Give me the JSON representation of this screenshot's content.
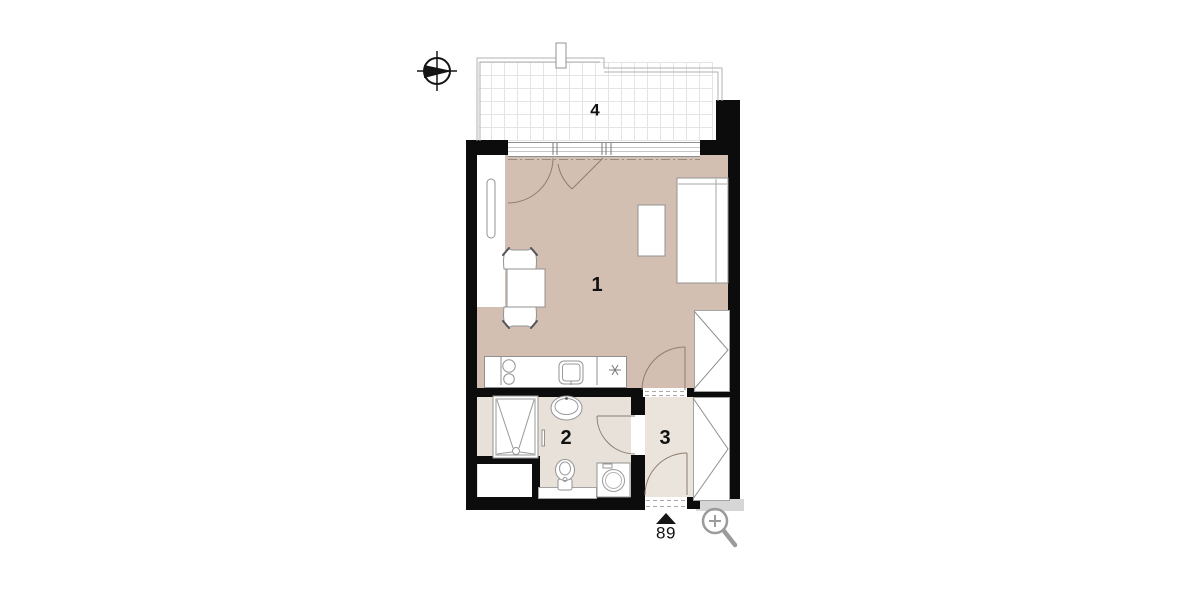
{
  "title": "apartment-floor-plan",
  "plan": {
    "rooms": [
      {
        "id": "living-kitchen",
        "label": "1"
      },
      {
        "id": "bathroom",
        "label": "2"
      },
      {
        "id": "hall",
        "label": "3"
      },
      {
        "id": "balcony",
        "label": "4"
      }
    ],
    "entrance": {
      "unit_number": "89"
    }
  },
  "icons": {
    "compass": "compass-rose-icon",
    "zoom": "magnifier-plus-icon",
    "entrance_marker": "entrance-triangle-marker"
  },
  "colors": {
    "wall": "#0c0c0c",
    "room1": "#d3bfb2",
    "room2": "#e7e1da",
    "room3": "#eae4dc",
    "strip": "#d6d6d6",
    "door": "#8d7d71",
    "balcony_grid": "#e4e4e4"
  }
}
